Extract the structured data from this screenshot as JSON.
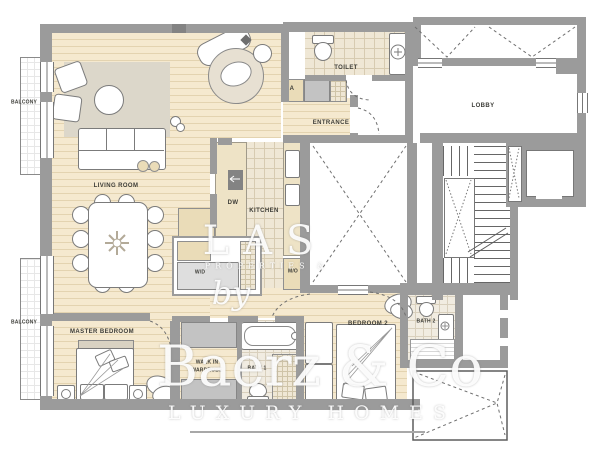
{
  "plan": {
    "labels": {
      "balcony_top": "BALCONY",
      "balcony_bottom": "BALCONY",
      "living_room": "LIVING ROOM",
      "entrance": "ENTRANCE",
      "toilet": "TOILET",
      "closet_a": "A",
      "lobby": "LOBBY",
      "dishwasher": "DW",
      "kitchen": "KITCHEN",
      "washer_dryer": "W/D",
      "micro_oven": "M/O",
      "master_bedroom": "MASTER BEDROOM",
      "walk_in_line1": "WALK IN",
      "walk_in_line2": "WARDROBE",
      "bath_1": "BATH 1",
      "bedroom_2": "BEDROOM 2",
      "bath_2": "BATH 2"
    },
    "watermark": {
      "brand_top": "LAS",
      "brand_sub": "PROPERTIES &",
      "brand_by": "by",
      "brand_name": "Baerz & Co",
      "brand_tagline": "LUXURY HOMES"
    },
    "colors": {
      "wall": "#9b9b9b",
      "wood_floor": "#f5e9cf",
      "wood_plank_line": "#e3d3b0",
      "tile_floor": "#efe7d5",
      "tile_line": "#d7cbb1",
      "rug": "#dcd7ca",
      "counter": "#eee3c6",
      "watermark": "#ffffff"
    }
  }
}
